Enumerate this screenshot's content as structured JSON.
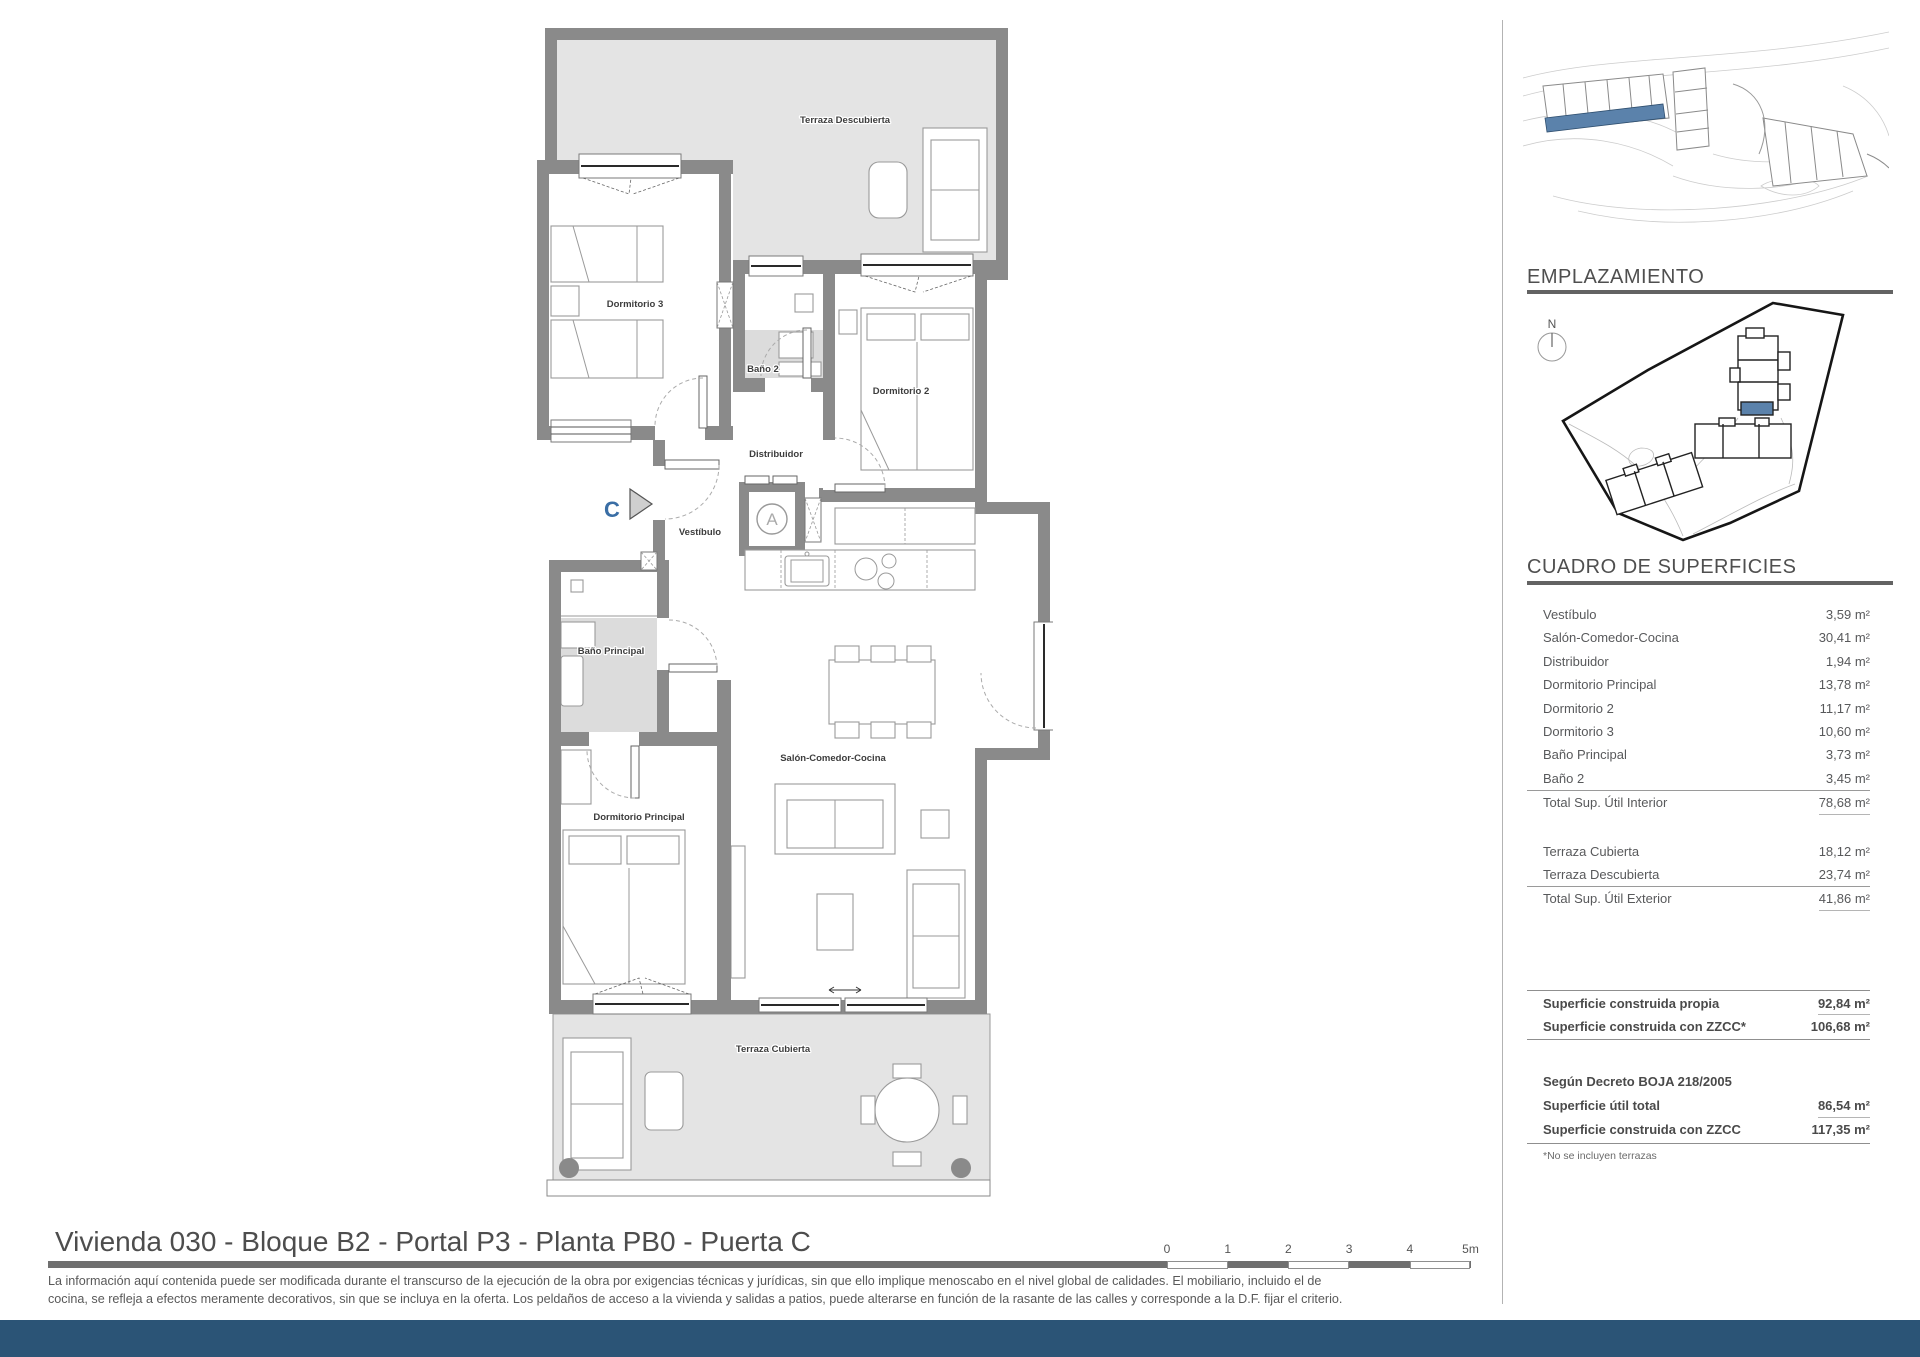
{
  "plan": {
    "labels": {
      "terraza_descubierta": "Terraza Descubierta",
      "dormitorio3": "Dormitorio 3",
      "bano2": "Baño 2",
      "dormitorio2": "Dormitorio 2",
      "distribuidor": "Distribuidor",
      "vestibulo": "Vestíbulo",
      "bano_principal": "Baño Principal",
      "dormitorio_principal": "Dormitorio Principal",
      "salon": "Salón-Comedor-Cocina",
      "terraza_cubierta": "Terraza Cubierta"
    },
    "entry_marker": "C",
    "shaft_marker": "A",
    "compass_letter": "N"
  },
  "sidebar": {
    "emplazamiento_title": "EMPLAZAMIENTO",
    "cuadro_title": "CUADRO DE SUPERFICIES",
    "table": {
      "interior_rows": [
        {
          "label": "Vestíbulo",
          "value": "3,59 m²"
        },
        {
          "label": "Salón-Comedor-Cocina",
          "value": "30,41 m²"
        },
        {
          "label": "Distribuidor",
          "value": "1,94 m²"
        },
        {
          "label": "Dormitorio Principal",
          "value": "13,78 m²"
        },
        {
          "label": "Dormitorio 2",
          "value": "11,17 m²"
        },
        {
          "label": "Dormitorio 3",
          "value": "10,60 m²"
        },
        {
          "label": "Baño Principal",
          "value": "3,73 m²"
        },
        {
          "label": "Baño 2",
          "value": "3,45 m²"
        }
      ],
      "interior_total": {
        "label": "Total Sup. Útil Interior",
        "value": "78,68 m²"
      },
      "exterior_rows": [
        {
          "label": "Terraza Cubierta",
          "value": "18,12 m²"
        },
        {
          "label": "Terraza Descubierta",
          "value": "23,74 m²"
        }
      ],
      "exterior_total": {
        "label": "Total Sup. Útil Exterior",
        "value": "41,86 m²"
      },
      "built_rows": [
        {
          "label": "Superficie construida propia",
          "value": "92,84 m²"
        },
        {
          "label": "Superficie construida con ZZCC*",
          "value": "106,68 m²"
        }
      ],
      "decree_heading": "Según Decreto BOJA 218/2005",
      "decree_rows": [
        {
          "label": "Superficie útil total",
          "value": "86,54 m²"
        },
        {
          "label": "Superficie construida con ZZCC",
          "value": "117,35 m²"
        }
      ],
      "footnote": "*No se incluyen terrazas"
    }
  },
  "footer": {
    "title": "Vivienda 030 - Bloque B2 - Portal P3 - Planta PB0 - Puerta C",
    "disclaimer_lines": [
      "La información aquí contenida puede ser modificada durante el transcurso de la ejecución de la obra por exigencias técnicas y jurídicas, sin que ello implique menoscabo en el nivel global de calidades. El mobiliario, incluido el de",
      "cocina, se refleja a efectos meramente decorativos, sin que se incluya en la oferta. Los peldaños de acceso a la vivienda y salidas a patios, puede alterarse en función de la rasante de las calles y corresponde a la D.F. fijar el criterio."
    ],
    "scale_ticks": [
      "0",
      "1",
      "2",
      "3",
      "4",
      "5m"
    ]
  },
  "colors": {
    "accent_blue": "#3a6ea5",
    "unit_highlight": "#5b82ab",
    "footer_bar": "#2b5476",
    "wall_gray": "#8a8a8a"
  }
}
